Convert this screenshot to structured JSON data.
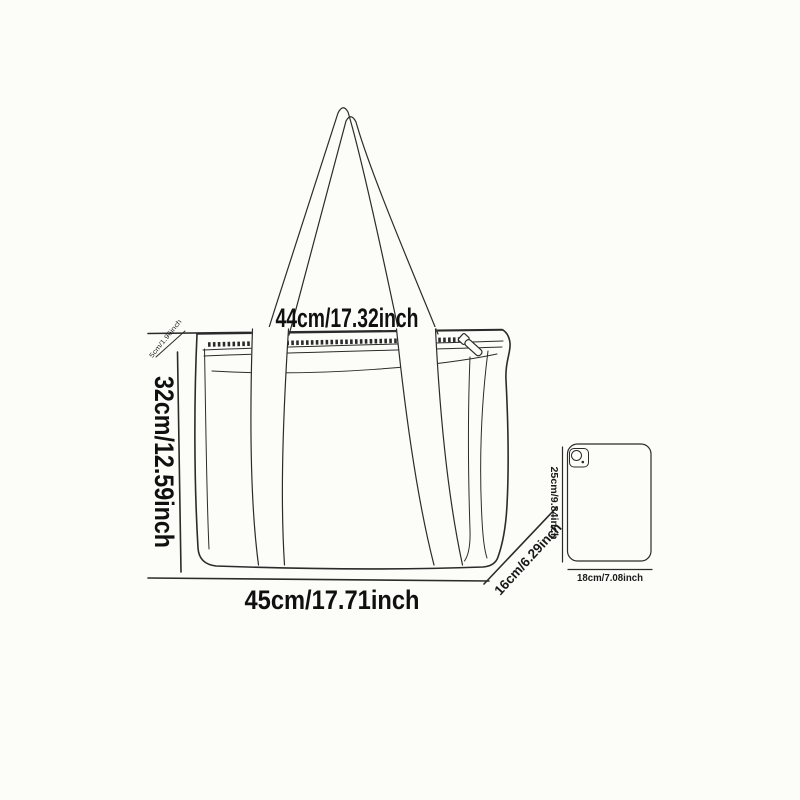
{
  "title": "Tote bag size specification diagram",
  "colors": {
    "background": "#fcfcf8",
    "line_art": "#2b2b2b",
    "text": "#101010"
  },
  "bag_labels": {
    "top_width": "44cm/17.32inch",
    "height": "32cm/12.59inch",
    "bottom_width": "45cm/17.71inch",
    "depth": "16cm/6.29inch",
    "top_trim": "5cm/1.96inch"
  },
  "reference_labels": {
    "tablet_height": "25cm/9.84inch",
    "tablet_width": "18cm/7.08inch"
  }
}
